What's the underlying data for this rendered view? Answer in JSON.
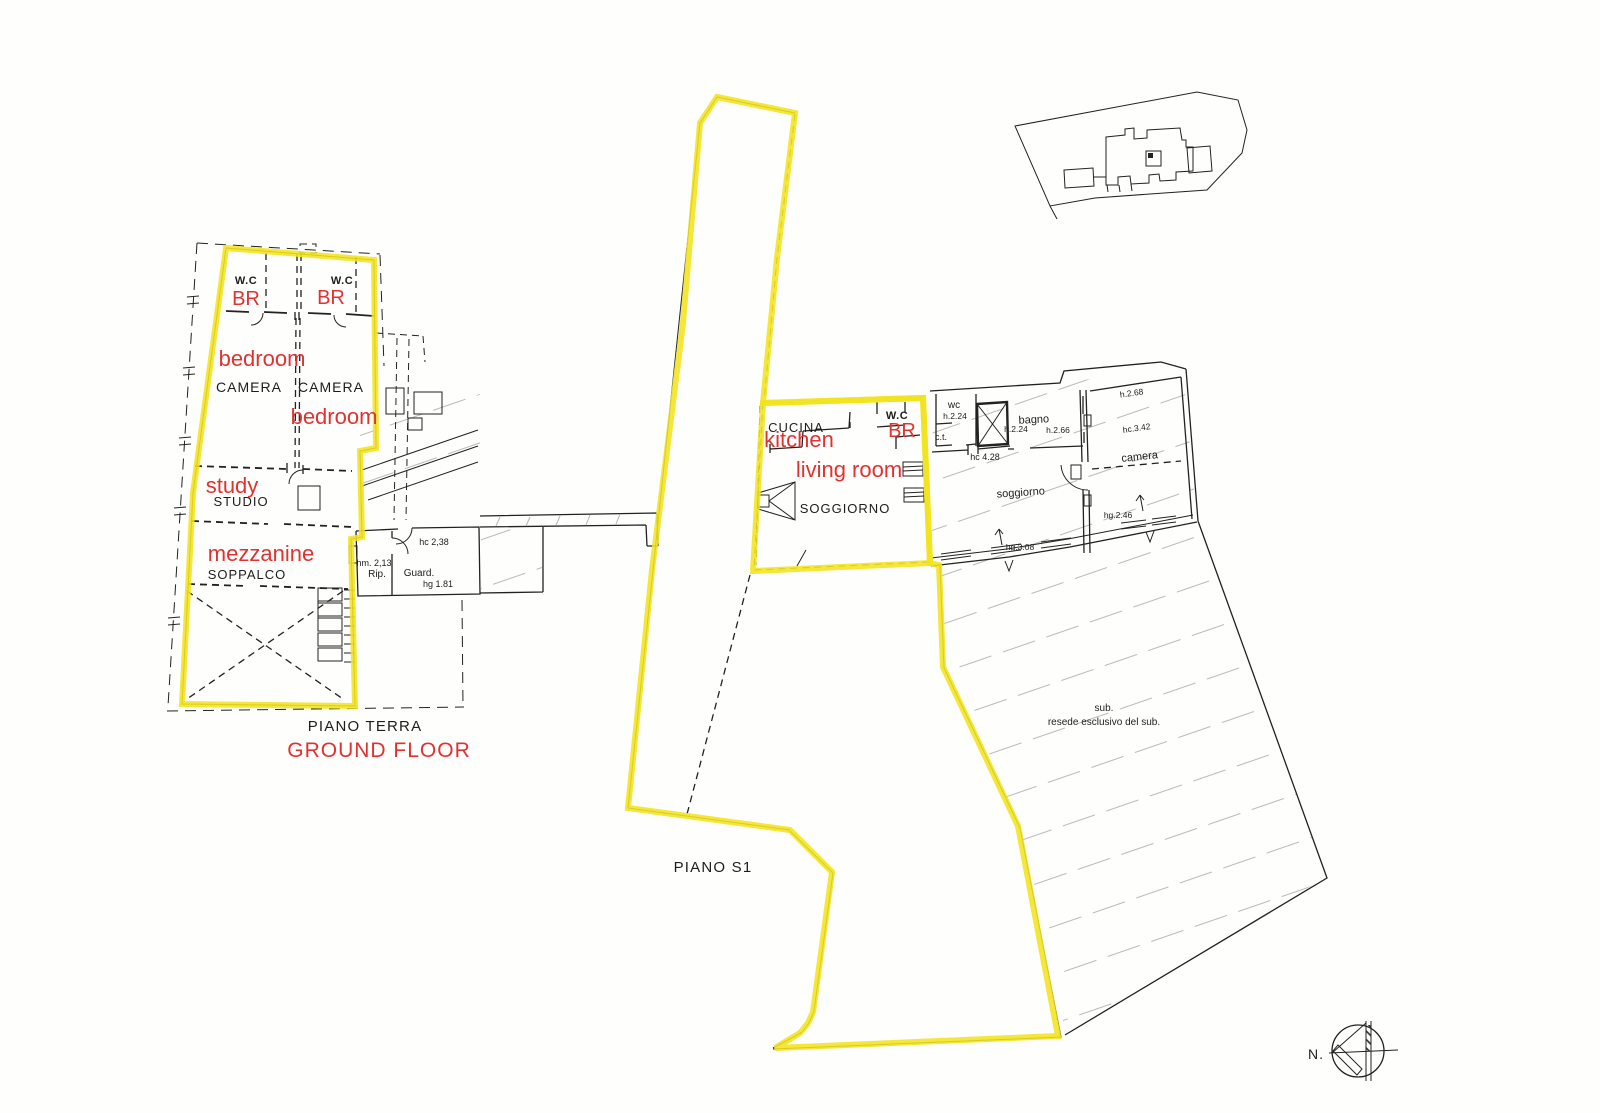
{
  "colors": {
    "highlight": "#F2E41F",
    "annotation": "#E03231",
    "ink": "#222222",
    "hatch": "#B5B5B5",
    "paper": "#FEFEFC"
  },
  "ground_floor": {
    "floor_title": "PIANO TERRA",
    "plan_labels": {
      "wc_left": "W.C",
      "wc_right": "W.C",
      "camera_left": "CAMERA",
      "camera_right": "CAMERA",
      "studio": "STUDIO",
      "soppalco": "SOPPALCO",
      "rip": "Rip.",
      "guard": "Guard."
    },
    "dimensions": {
      "hm_2_13": "hm. 2,13",
      "hc_2_38": "hc 2,38",
      "hg_1_81": "hg 1.81"
    },
    "annotations": {
      "br_left": "BR",
      "br_right": "BR",
      "bedroom_left": "bedroom",
      "bedroom_right": "bedroom",
      "study": "study",
      "mezzanine": "mezzanine",
      "floor_en": "GROUND FLOOR"
    }
  },
  "s1_floor": {
    "floor_title": "PIANO S1",
    "unit_labels": {
      "cucina": "CUCINA",
      "wc": "W.C",
      "soggiorno": "SOGGIORNO"
    },
    "annotations": {
      "kitchen": "kitchen",
      "br": "BR",
      "living_room": "living room"
    },
    "adjacent_labels": {
      "wc": "wc",
      "wc_h": "h.2.24",
      "ct": "c.t.",
      "bagno": "bagno",
      "bagno_h": "h.2.24",
      "bagno_h2": "h.2.66",
      "hc_4_28": "hc 4.28",
      "soggiorno": "soggiorno",
      "h_2_68": "h.2.68",
      "hc_3_42": "hc.3.42",
      "camera": "camera",
      "hg_2_46": "hg.2.46",
      "hg_3_08": "hg.3.08"
    },
    "resede": {
      "line1": "sub.",
      "line2": "resede esclusivo del sub."
    }
  },
  "compass": {
    "north_label": "N."
  }
}
